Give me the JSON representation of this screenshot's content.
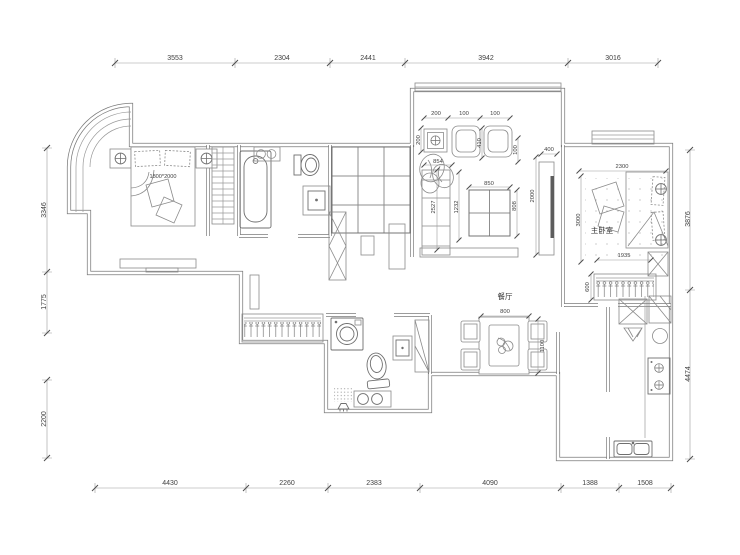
{
  "plan": {
    "rooms": {
      "master_bedroom": "主卧室",
      "dining": "餐厅"
    },
    "bed_label": "1800*2000",
    "dims_top": [
      "3553",
      "2304",
      "2441",
      "3942",
      "3016"
    ],
    "dims_bottom": [
      "4430",
      "2260",
      "2383",
      "4090",
      "1388",
      "1508"
    ],
    "dims_left": [
      "3346",
      "1775",
      "2200"
    ],
    "dims_right": [
      "3876",
      "4474"
    ],
    "dims_living": {
      "t1": "200",
      "t2": "100",
      "t3": "100",
      "v1": "200",
      "v2": "410",
      "v3": "100",
      "sofa_top": "854",
      "sofa_len": "2527",
      "sofa_gap": "1232",
      "table_w": "850",
      "table_h": "808",
      "tv_len": "2000",
      "tv_depth": "400"
    },
    "dims_master": {
      "width": "2300",
      "depth": "3000",
      "wardrobe_len": "1935",
      "wardrobe_depth": "600"
    },
    "dims_dining": {
      "table": "800",
      "length": "1100"
    }
  }
}
